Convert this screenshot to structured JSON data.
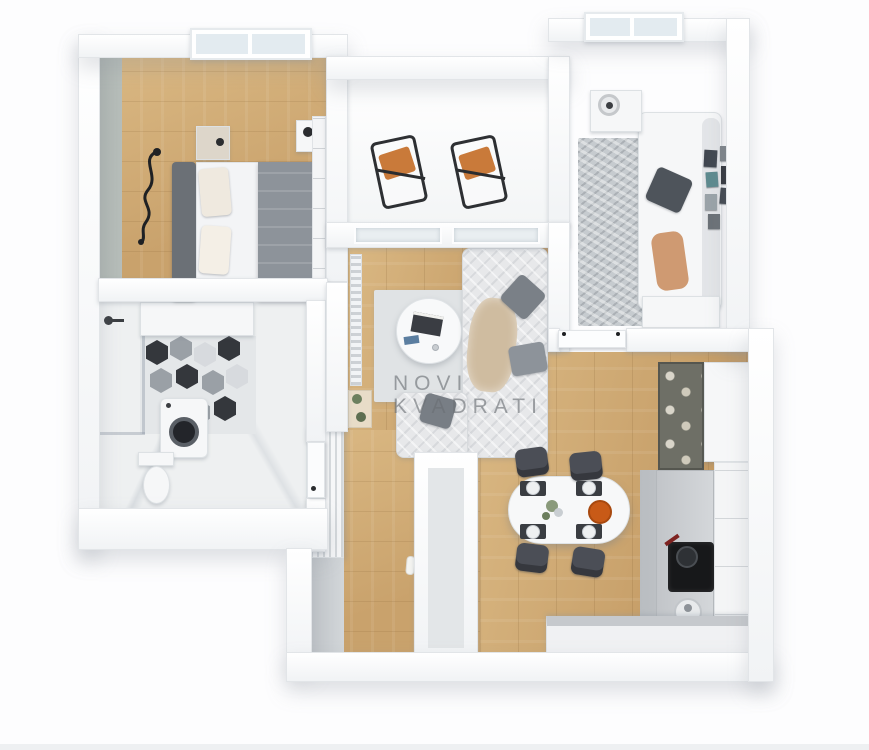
{
  "watermark": {
    "line1": "NOVI",
    "line2": "KVADRATI"
  },
  "palette": {
    "background": "#fdfdfe",
    "wall": "#f4f6f7",
    "wall_edge": "#d6dade",
    "floor_wood": "#c9a26c",
    "floor_wood_dark": "#b68a55",
    "floor_wood_light": "#dab883",
    "marble": "#eef0f1",
    "accent_wall": "#b7beba",
    "rug": "#e0e3e5",
    "rug_dark": "#c6cbcf",
    "sofa": "#e7e8ea",
    "sofa_white": "#f1f2f3",
    "pillow_gray": "#7a8087",
    "pillow_dark": "#4e545b",
    "duvet": "#8d939a",
    "headboard": "#6b7076",
    "chair_dark": "#4b4e56",
    "cushion_orange": "#c97a3a",
    "bowl_orange": "#c85a17",
    "throw_beige": "#cfbca0",
    "throw_peach": "#cf9a72",
    "counter": "#eef0f2",
    "counter_top": "#c6c9cd",
    "cooktop": "#17181a",
    "glass": "#e9eef1",
    "hex_dark": "#34373c",
    "hex_gray": "#9aa0a6",
    "hex_light": "#d7dade",
    "plant": "#6c7f5e",
    "watermark": "#6a6f74"
  }
}
